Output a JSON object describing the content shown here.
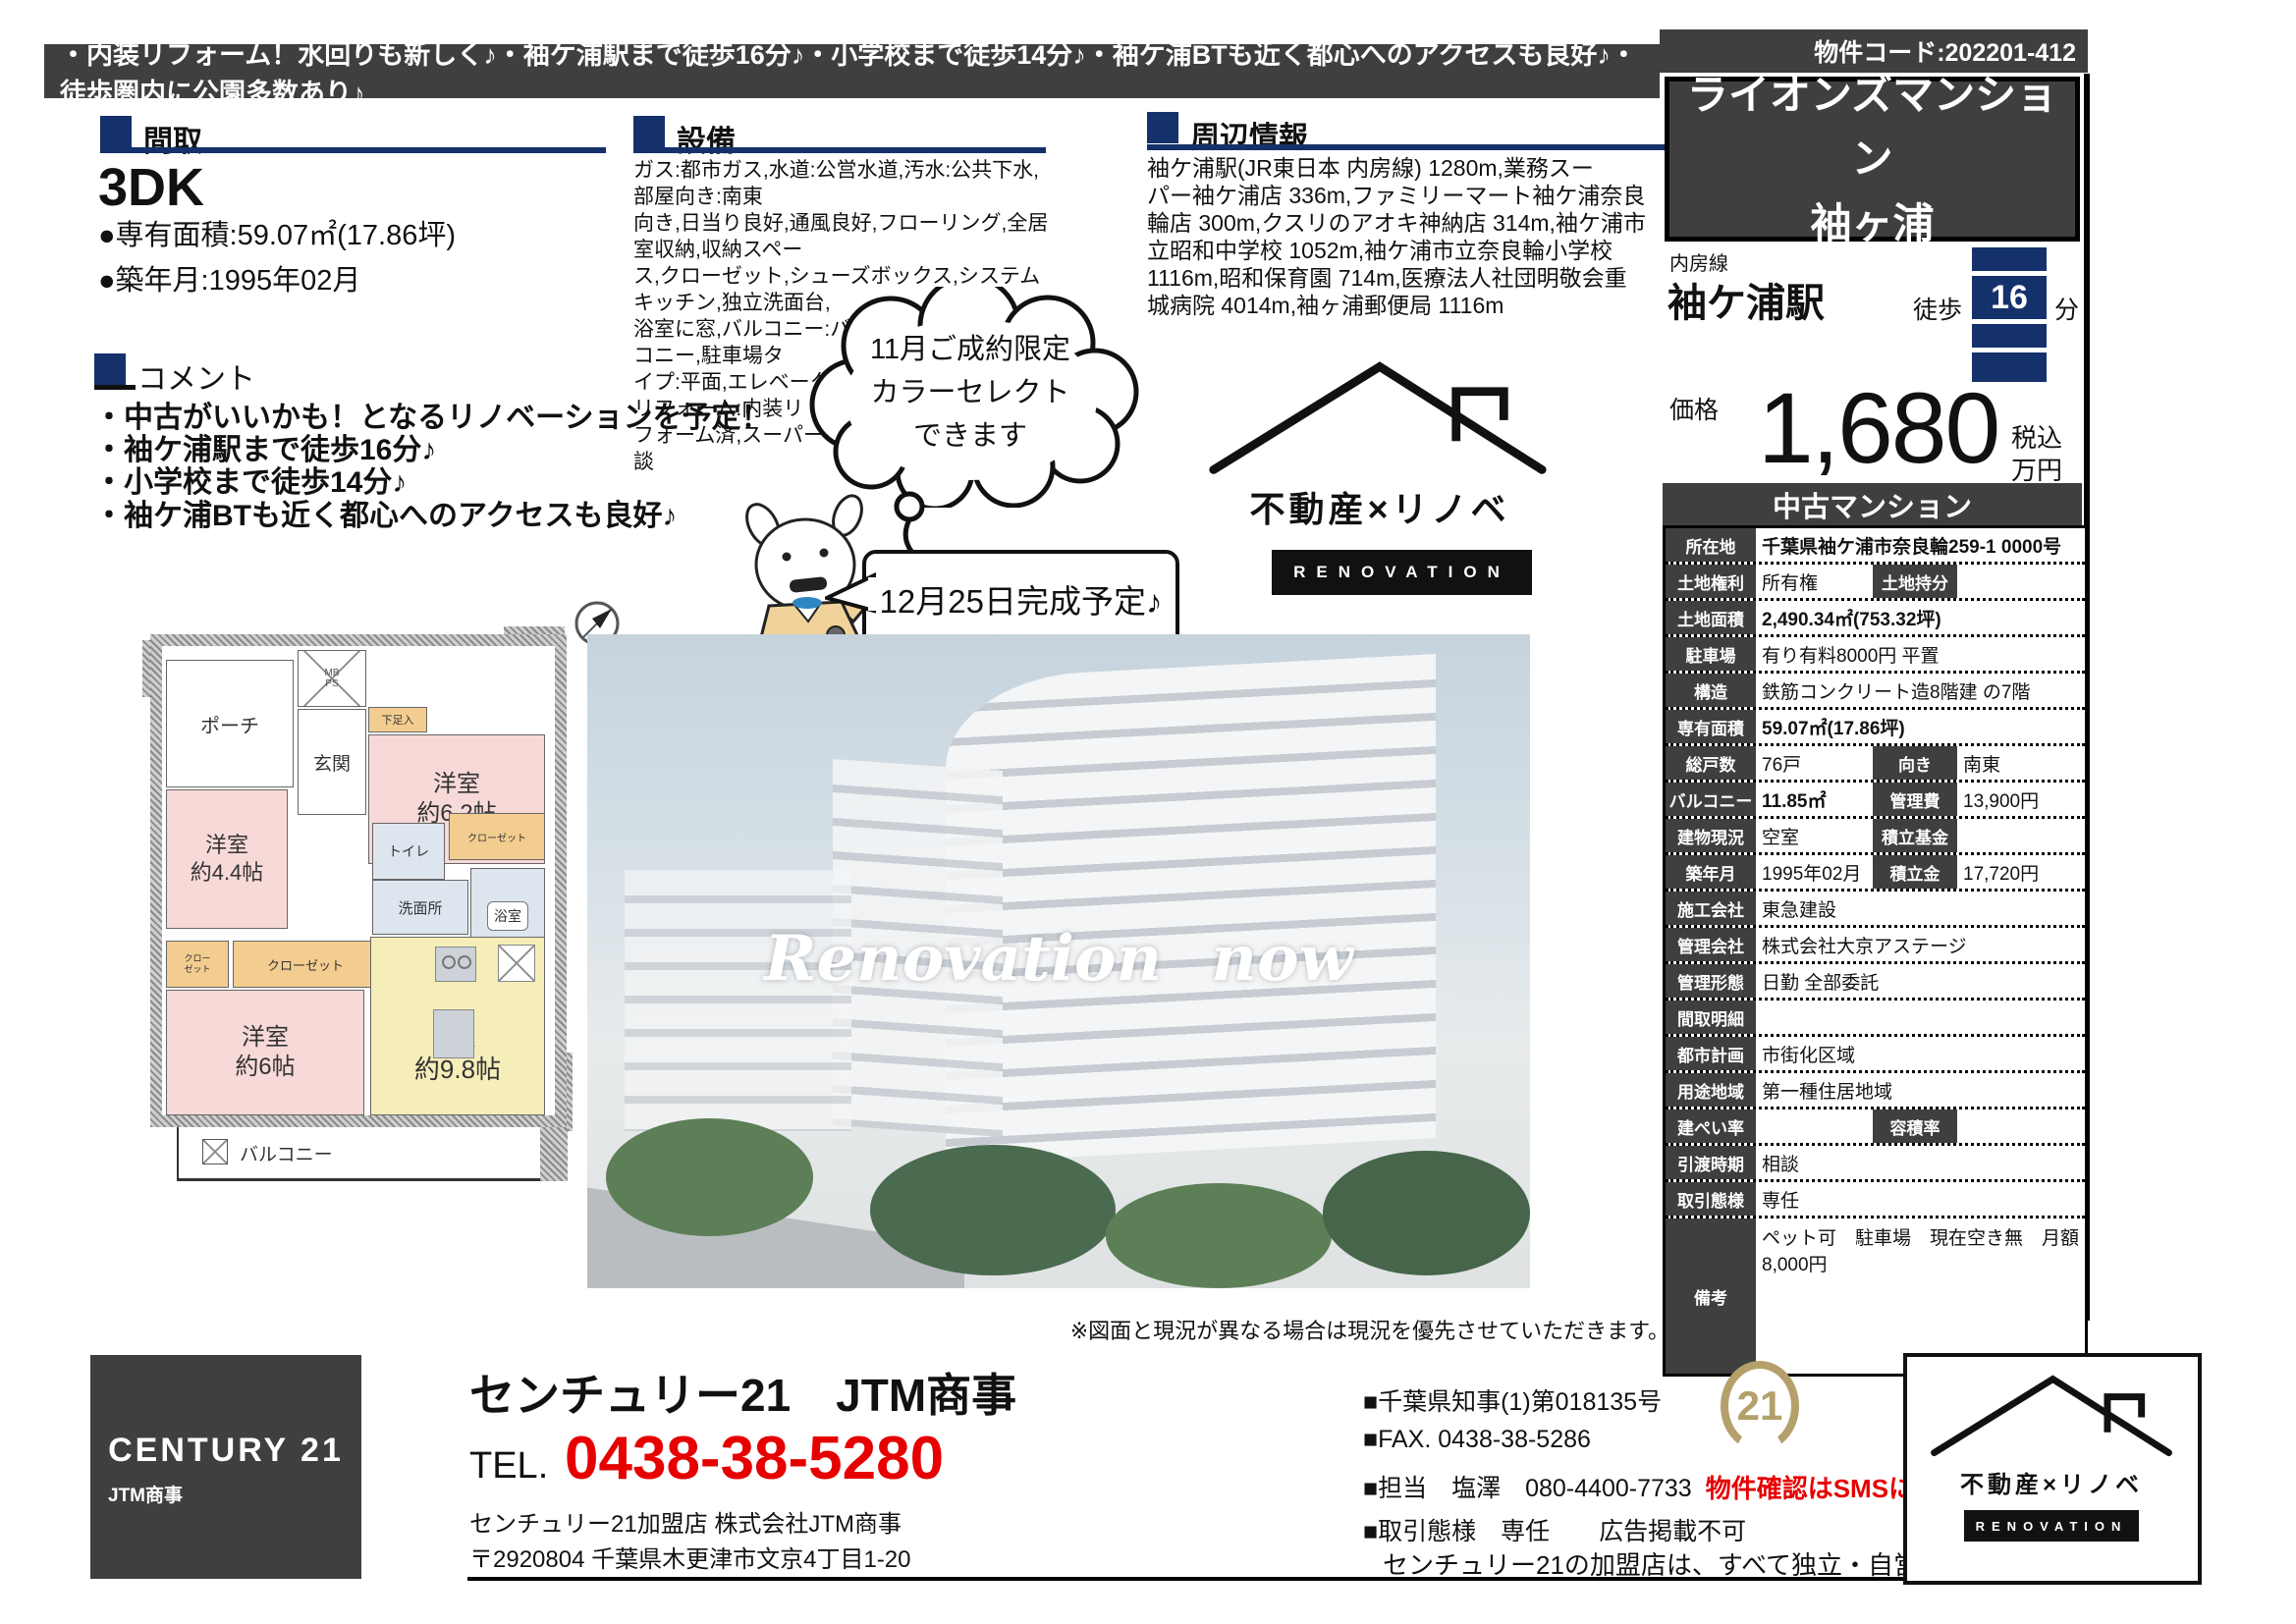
{
  "colors": {
    "accent_navy": "#14316b",
    "charcoal": "#3f3f3f",
    "alert_red": "#e60000",
    "seal_gold": "#b4a06b",
    "room_pink": "#f7d9d8",
    "room_yellow": "#f6eeb9",
    "room_orange": "#f3cd90",
    "room_blue": "#dde6ef"
  },
  "top": {
    "tagline": "・内装リフォーム！水回りも新しく♪・袖ケ浦駅まで徒歩16分♪・小学校まで徒歩14分♪・袖ケ浦BTも近く都心へのアクセスも良好♪・徒歩圏内に公園多数あり♪",
    "property_code": "物件コード:202201-412"
  },
  "sections": {
    "madori": {
      "heading": "間取",
      "type": "3DK",
      "area_line": "●専有面積:59.07㎡(17.86坪)",
      "built_line": "●築年月:1995年02月"
    },
    "setsubi": {
      "heading": "設備",
      "body": "ガス:都市ガス,水道:公営水道,汚水:公共下水,部屋向き:南東\n向き,日当り良好,通風良好,フローリング,全居室収納,収納スペー\nス,クローゼット,シューズボックス,システムキッチン,独立洗面台,\n浴室に窓,バルコニー:バルコニー有,南面バルコニー,駐車場タ\nイプ:平面,エレベーター,駐輪場,管理人:日勤,リフォーム:内装リ\nフォーム済,スーパー 徒歩10分以内,ペット:相談"
    },
    "shuhen": {
      "heading": "周辺情報",
      "body": "袖ケ浦駅(JR東日本 内房線) 1280m,業務スー\nパー袖ケ浦店 336m,ファミリーマート袖ケ浦奈良\n輪店 300m,クスリのアオキ神納店 314m,袖ケ浦市\n立昭和中学校 1052m,袖ケ浦市立奈良輪小学校\n1116m,昭和保育園 714m,医療法人社団明敬会重\n城病院 4014m,袖ヶ浦郵便局 1116m"
    },
    "comment": {
      "heading": "コメント",
      "lines": [
        "・中古がいいかも！となるリノベーションを予定！",
        "・袖ケ浦駅まで徒歩16分♪",
        "・小学校まで徒歩14分♪",
        "・袖ケ浦BTも近く都心へのアクセスも良好♪"
      ]
    }
  },
  "mascot": {
    "cloud_bubble": "11月ご成約限定\nカラーセレクト\nできます",
    "rect_bubble": "12月25日完成予定♪"
  },
  "reno_logo": {
    "name": "不動産×リノベ",
    "sub": "RENOVATION"
  },
  "photo": {
    "overlay": "Renovation now",
    "caption": "※図面と現況が異なる場合は現況を優先させていただきます。"
  },
  "floorplan": {
    "porch": "ポーチ",
    "entrance": "玄関",
    "mb": "MB\nPS",
    "shoe": "下足入",
    "room1": "洋室\n約6.2帖",
    "room2": "洋室\n約4.4帖",
    "toilet": "トイレ",
    "closet_top": "クローゼット",
    "wash": "洗面所",
    "bath": "浴室",
    "closet_side": "クロー\nゼット",
    "closet_mid": "クローゼット",
    "room3": "洋室\n約6帖",
    "dk": "DK\n約9.8帖",
    "balcony": "バルコニー"
  },
  "listing": {
    "title": "ライオンズマンション\n袖ヶ浦",
    "line_name": "内房線",
    "station": "袖ケ浦駅",
    "walk_label": "徒歩",
    "walk_minutes": "16",
    "walk_unit": "分",
    "price_label": "価格",
    "price_value": "1,680",
    "price_note": "税込\n万円",
    "category": "中古マンション",
    "table": {
      "rows": [
        {
          "l": "所在地",
          "v": "千葉県袖ケ浦市奈良輪259-1 0000号",
          "bold": true
        },
        {
          "l": "土地権利",
          "v": "所有権",
          "l2": "土地持分",
          "v2": ""
        },
        {
          "l": "土地面積",
          "v": "2,490.34㎡(753.32坪)",
          "bold": true
        },
        {
          "l": "駐車場",
          "v": "有り有料8000円 平置"
        },
        {
          "l": "構造",
          "v": "鉄筋コンクリート造8階建 の7階"
        },
        {
          "l": "専有面積",
          "v": "59.07㎡(17.86坪)",
          "bold": true
        },
        {
          "l": "総戸数",
          "v": "76戸",
          "l2": "向き",
          "v2": "南東"
        },
        {
          "l": "バルコニー",
          "v": "11.85㎡",
          "l2": "管理費",
          "v2": "13,900円",
          "bold": true
        },
        {
          "l": "建物現況",
          "v": "空室",
          "l2": "積立基金",
          "v2": ""
        },
        {
          "l": "築年月",
          "v": "1995年02月",
          "l2": "積立金",
          "v2": "17,720円"
        },
        {
          "l": "施工会社",
          "v": "東急建設"
        },
        {
          "l": "管理会社",
          "v": "株式会社大京アステージ"
        },
        {
          "l": "管理形態",
          "v": "日勤 全部委託"
        },
        {
          "l": "間取明細",
          "v": ""
        },
        {
          "l": "都市計画",
          "v": "市街化区域"
        },
        {
          "l": "用途地域",
          "v": "第一種住居地域"
        },
        {
          "l": "建ぺい率",
          "v": "",
          "l2": "容積率",
          "v2": ""
        },
        {
          "l": "引渡時期",
          "v": "相談"
        },
        {
          "l": "取引態様",
          "v": "専任"
        },
        {
          "l": "備考",
          "v": "ペット可　駐車場　現在空き無　月額8,000円",
          "tall": true
        }
      ]
    }
  },
  "footer": {
    "c21_brand": "CENTURY 21",
    "c21_store": "JTM商事",
    "store_name": "センチュリー21　JTM商事",
    "tel_label": "TEL.",
    "tel_number": "0438-38-5280",
    "member_line": "センチュリー21加盟店 株式会社JTM商事",
    "address_line": "〒2920804 千葉県木更津市文京4丁目1-20",
    "license": "■千葉県知事(1)第018135号",
    "fax": "■FAX. 0438-38-5286",
    "contact": "■担当　塩澤　080-4400-7733",
    "sms_note": "物件確認はSMSにて",
    "deal_line": "■取引態様　専任　　広告掲載不可",
    "disclaimer": "センチュリー21の加盟店は、すべて独立・自営です。",
    "seal_number": "21"
  }
}
